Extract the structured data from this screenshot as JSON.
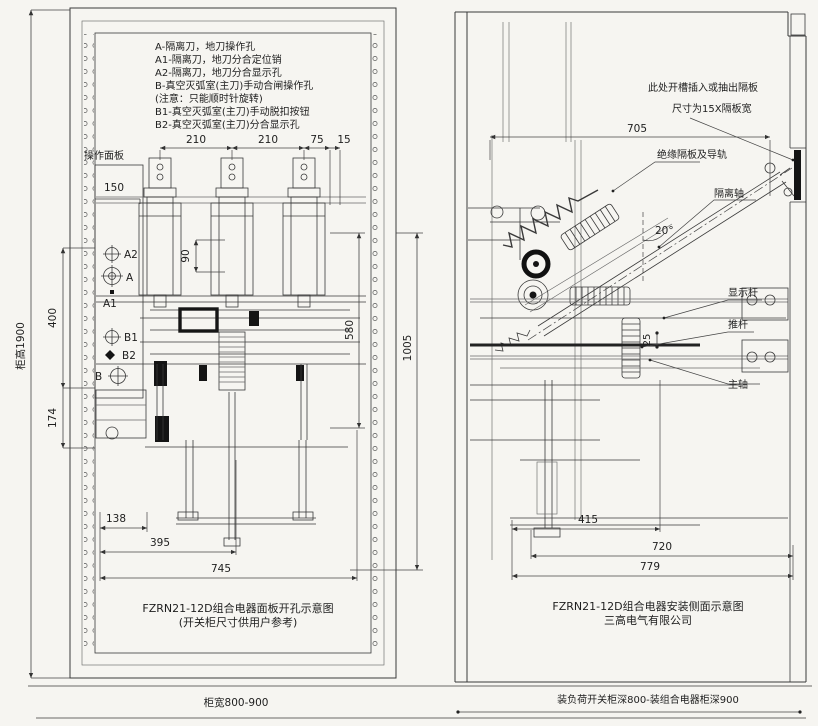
{
  "left": {
    "panel_label": "操作面板",
    "legend": [
      "A-隔离刀，地刀操作孔",
      "A1-隔离刀，地刀分合定位销",
      "A2-隔离刀，地刀分合显示孔",
      "B-真空灭弧室(主刀)手动合闸操作孔",
      "(注意：只能顺时针旋转)",
      "B1-真空灭弧室(主刀)手动脱扣按钮",
      "B2-真空灭弧室(主刀)分合显示孔"
    ],
    "markers": {
      "a2": "A2",
      "a": "A",
      "a1": "A1",
      "b1": "B1",
      "b2": "B2",
      "b": "B"
    },
    "dims": {
      "span1": "210",
      "span2": "210",
      "span3": "75",
      "span4": "15",
      "width150": "150",
      "h90": "90",
      "v400": "400",
      "v174": "174",
      "v580": "580",
      "v1005": "1005",
      "b138": "138",
      "b395": "395",
      "b745": "745",
      "cab_height": "柜高1900",
      "cab_width": "柜宽800-900"
    },
    "caption": [
      "FZRN21-12D组合电器面板开孔示意图",
      "(开关柜尺寸供用户参考)"
    ]
  },
  "right": {
    "notes": [
      "此处开槽插入或抽出隔板",
      "尺寸为15X隔板宽"
    ],
    "labels": {
      "rail": "绝缘隔板及导轨",
      "iso_shaft": "隔离轴",
      "angle": "20°",
      "display_rod": "显示杆",
      "push_rod": "推杆",
      "main_shaft": "主轴"
    },
    "dims": {
      "t705": "705",
      "g25": "25",
      "b415": "415",
      "b720": "720",
      "b779": "779",
      "depth": "装负荷开关柜深800-装组合电器柜深900"
    },
    "caption": [
      "FZRN21-12D组合电器安装侧面示意图",
      "三高电气有限公司"
    ]
  }
}
